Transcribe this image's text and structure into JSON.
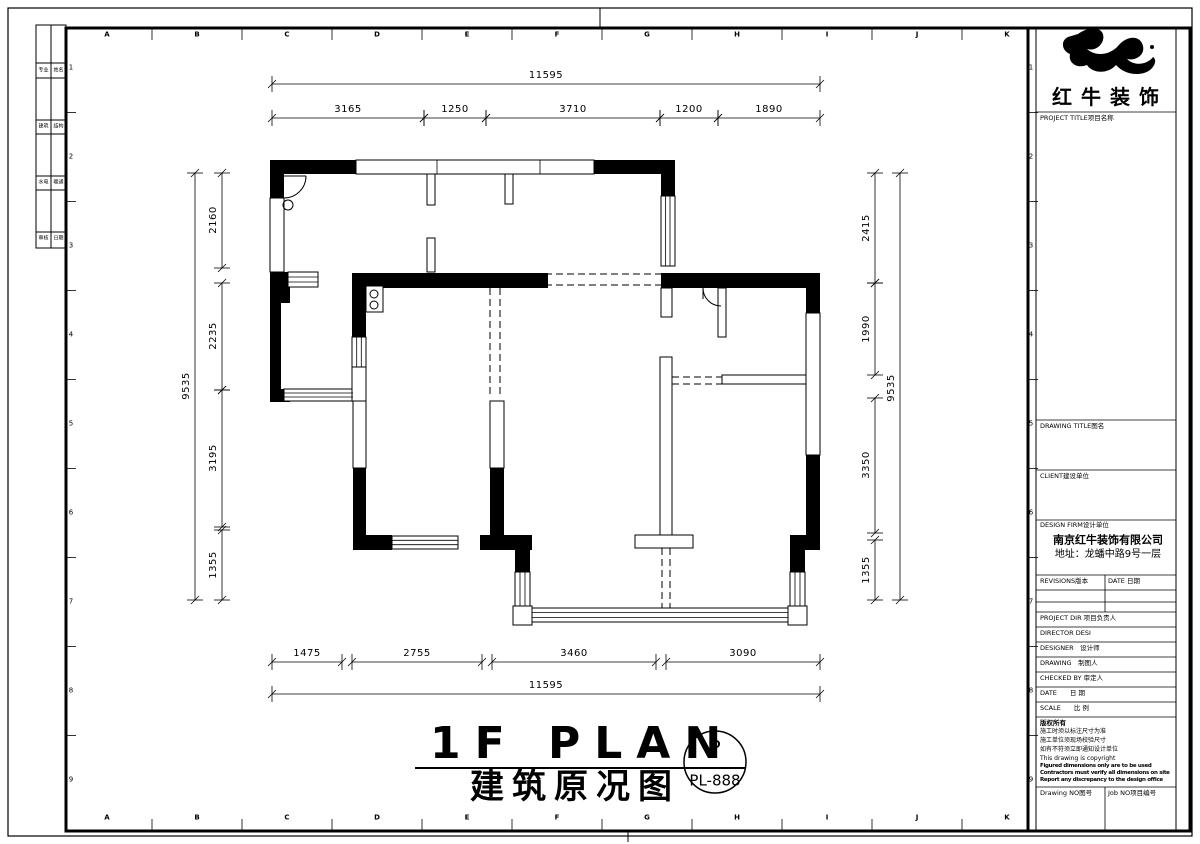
{
  "frame": {
    "grid_letters": [
      "A",
      "B",
      "C",
      "D",
      "E",
      "F",
      "G",
      "H",
      "I",
      "J",
      "K"
    ],
    "grid_numbers": [
      "1",
      "2",
      "3",
      "4",
      "5",
      "6",
      "7",
      "8",
      "9"
    ],
    "signoff_rows": [
      [
        "专业",
        "姓名"
      ],
      [
        "建筑",
        "结构"
      ],
      [
        "水电",
        "暖通"
      ],
      [
        "审核",
        "日期"
      ]
    ]
  },
  "plan": {
    "title_en": "1F PLAN",
    "title_zh": "建筑原况图",
    "badge_letter": "P",
    "badge_code": "PL-888",
    "dimensions": {
      "top": {
        "overall": "11595",
        "segments": [
          "3165",
          "1250",
          "3710",
          "1200",
          "1890"
        ]
      },
      "bottom": {
        "overall": "11595",
        "segments": [
          "1475",
          "2755",
          "3460",
          "3090"
        ]
      },
      "left": {
        "overall": "9535",
        "segments": [
          "2160",
          "2235",
          "3195",
          "1355"
        ]
      },
      "right": {
        "overall": "9535",
        "segments": [
          "2415",
          "1990",
          "3350",
          "1355"
        ]
      }
    }
  },
  "titleblock": {
    "logo_text": "红牛装饰",
    "project_title": "PROJECT TITLE项目名称",
    "drawing_title": "DRAWING TITLE图名",
    "client": "CLIENT建设单位",
    "design_firm": "DESIGN FIRM设计单位",
    "firm_name": "南京红牛装饰有限公司",
    "firm_address": "地址：龙蟠中路9号一层",
    "revisions": "REVISIONS版本",
    "date_col": "DATE 日期",
    "project_dir": "PROJECT DIR 项目负责人",
    "director": "DIRECTOR DESI",
    "designer": "DESIGNER　设计师",
    "drawing_by": "DRAWING　制图人",
    "checked_by": "CHECKED BY 审定人",
    "date": "DATE　　日 期",
    "scale": "SCALE　　比 例",
    "copyright_title": "版权所有",
    "note1": "施工时须以标注尺寸为准",
    "note2": "施工单位须现场校验尺寸",
    "note3": "如有不符须立即通知设计单位",
    "note4": "This drawing is copyright",
    "note_en1": "Figured dimensions only are to be used",
    "note_en2": "Contractors must verify all dimensions on site",
    "note_en3": "Report any discrepancy to the design office",
    "drawing_no": "Drawing NO图号",
    "job_no": "Job NO项目编号"
  }
}
